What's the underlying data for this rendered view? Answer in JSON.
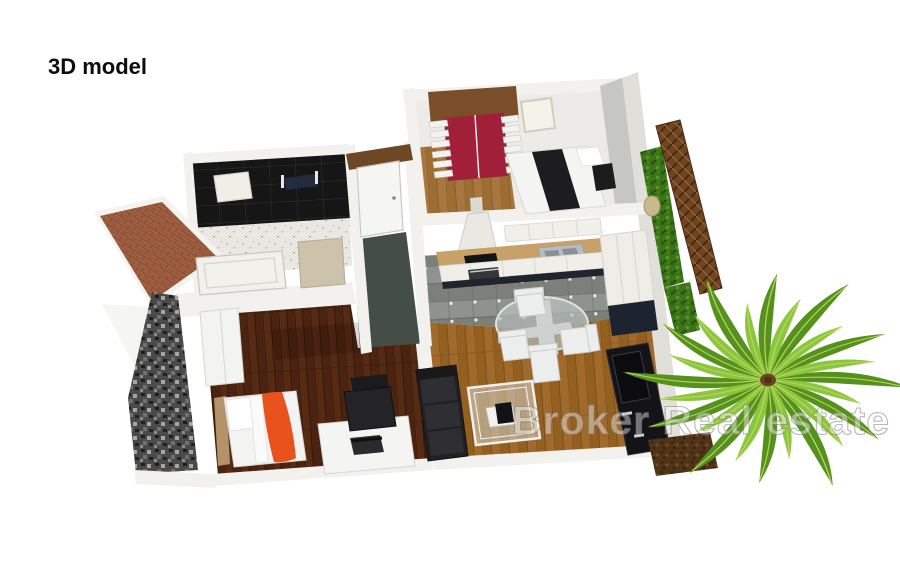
{
  "page": {
    "width": 900,
    "height": 563,
    "background": "#ffffff"
  },
  "header": {
    "title": "3D model"
  },
  "watermark": {
    "text": "Broker Real estate"
  },
  "palette": {
    "wall": "#f2f1ed",
    "wallShade": "#e0dfda",
    "wallInner": "#c6c6c2",
    "wardrobeRed": "#a21f3a",
    "bedBlanketBlack": "#1d1d1f",
    "blanketOrange": "#e8521c",
    "sofaBlack": "#212124",
    "consoleBlack": "#141418",
    "floorOak": "#a06a2c",
    "floorDarkWood": "#4a2410",
    "tileGray": "#8e938e",
    "tileBlack": "#161616",
    "counterWood": "#c8a169",
    "kickNavy": "#20242c",
    "hallFloor": "#454d47",
    "brick": "#a05f41",
    "stoneGray": "#4a4a4a",
    "fenceBrown": "#6f4522",
    "hedgeGreen": "#3c741c",
    "soilBrown": "#503418",
    "palmLight": "#8cc63e",
    "palmDark": "#55911d"
  },
  "scene": {
    "type": "3d-apartment-model-render",
    "rooms": [
      {
        "name": "bedroom-top",
        "items": [
          "red-wardrobe",
          "double-bed-black-blanket",
          "nightstand",
          "skylight-window",
          "wood-floor"
        ]
      },
      {
        "name": "bathroom",
        "items": [
          "black-tile-floor",
          "shower-mat",
          "towel-rail"
        ]
      },
      {
        "name": "second-bathroom",
        "items": [
          "bathtub",
          "vanity-cabinet",
          "speckled-wall"
        ]
      },
      {
        "name": "hallway",
        "items": [
          "entrance-door",
          "wood-door-frame",
          "dark-tile-floor"
        ]
      },
      {
        "name": "kitchen",
        "items": [
          "upper-cabinets",
          "range-hood",
          "wood-countertop",
          "cooktop",
          "oven",
          "sink",
          "base-cabinets",
          "tall-cabinets",
          "gray-tile-floor"
        ]
      },
      {
        "name": "dining-area",
        "items": [
          "round-glass-table",
          "four-white-chairs"
        ]
      },
      {
        "name": "living-room",
        "items": [
          "corner-sofa",
          "glass-coffee-table",
          "laptop",
          "tv-console",
          "oak-floor"
        ]
      },
      {
        "name": "bedroom-bottom",
        "items": [
          "single-bed-orange-blanket",
          "wardrobe",
          "desk",
          "laptop",
          "office-chair",
          "dark-wood-floor"
        ]
      }
    ],
    "exterior": [
      "brick-terrace",
      "stone-clad-wall",
      "white-facade",
      "lattice-fence",
      "hedge",
      "stepping-stone",
      "soil-bed",
      "palm-tree"
    ]
  }
}
